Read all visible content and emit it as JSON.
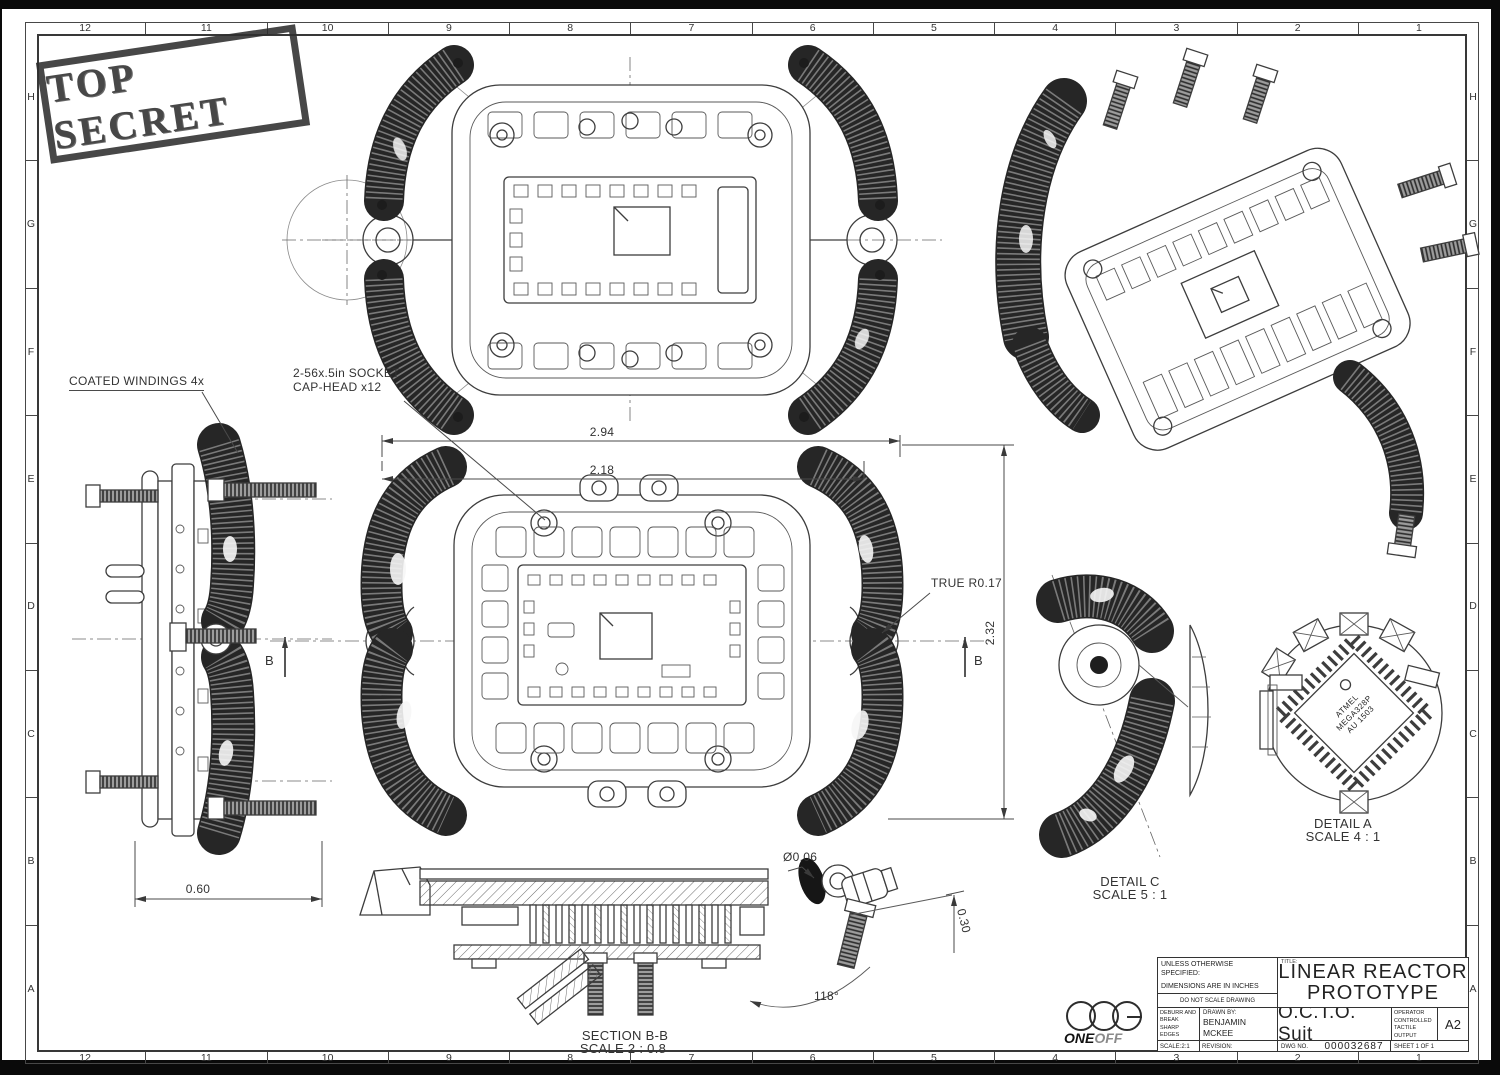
{
  "stamp": {
    "text": "TOP SECRET"
  },
  "grid": {
    "columns": [
      "12",
      "11",
      "10",
      "9",
      "8",
      "7",
      "6",
      "5",
      "4",
      "3",
      "2",
      "1"
    ],
    "rows": [
      "H",
      "G",
      "F",
      "E",
      "D",
      "C",
      "B",
      "A"
    ]
  },
  "callouts": {
    "coated": "COATED WINDINGS 4x",
    "socket_1": "2-56x.5in SOCKET",
    "socket_2": "CAP-HEAD x12",
    "true_r": "TRUE R0.17",
    "dia": "Ø0.06",
    "depth": "0.30",
    "angle": "118°",
    "b_left": "B",
    "b_right": "B"
  },
  "dims": {
    "d294": "2.94",
    "d218": "2.18",
    "d232": "2.32",
    "d060": "0.60"
  },
  "views": {
    "section_1": "SECTION B-B",
    "section_2": "SCALE 2 : 0.8",
    "detail_c_1": "DETAIL C",
    "detail_c_2": "SCALE 5 : 1",
    "detail_a_1": "DETAIL A",
    "detail_a_2": "SCALE 4 : 1"
  },
  "chip": {
    "line1": "ATMEL",
    "line2": "MEGA328P",
    "line3": "AU 1503"
  },
  "title_block": {
    "unless_1": "UNLESS OTHERWISE",
    "unless_2": "SPECIFIED:",
    "unless_3": "DIMENSIONS ARE IN INCHES",
    "do_not_scale": "DO NOT SCALE DRAWING",
    "deburr_1": "DEBURR AND",
    "deburr_2": "BREAK SHARP",
    "deburr_3": "EDGES",
    "drawn_by_label": "DRAWN BY:",
    "drawn_name_1": "BENJAMIN",
    "drawn_name_2": "MCKEE",
    "title_label": "TITLE:",
    "title_1": "LINEAR REACTOR",
    "title_2": "PROTOTYPE",
    "subtitle": "O.C.T.O.  Suit",
    "octo_1": "OPERATOR",
    "octo_2": "CONTROLLED",
    "octo_3": "TACTILE",
    "octo_4": "OUTPUT",
    "size": "A2",
    "scale": "SCALE:2:1",
    "revision": "REVISION:",
    "dwg_label": "DWG NO.",
    "dwg_no": "000032687",
    "sheet": "SHEET 1 OF 1",
    "logo_1": "ONE",
    "logo_2": "OFF"
  }
}
